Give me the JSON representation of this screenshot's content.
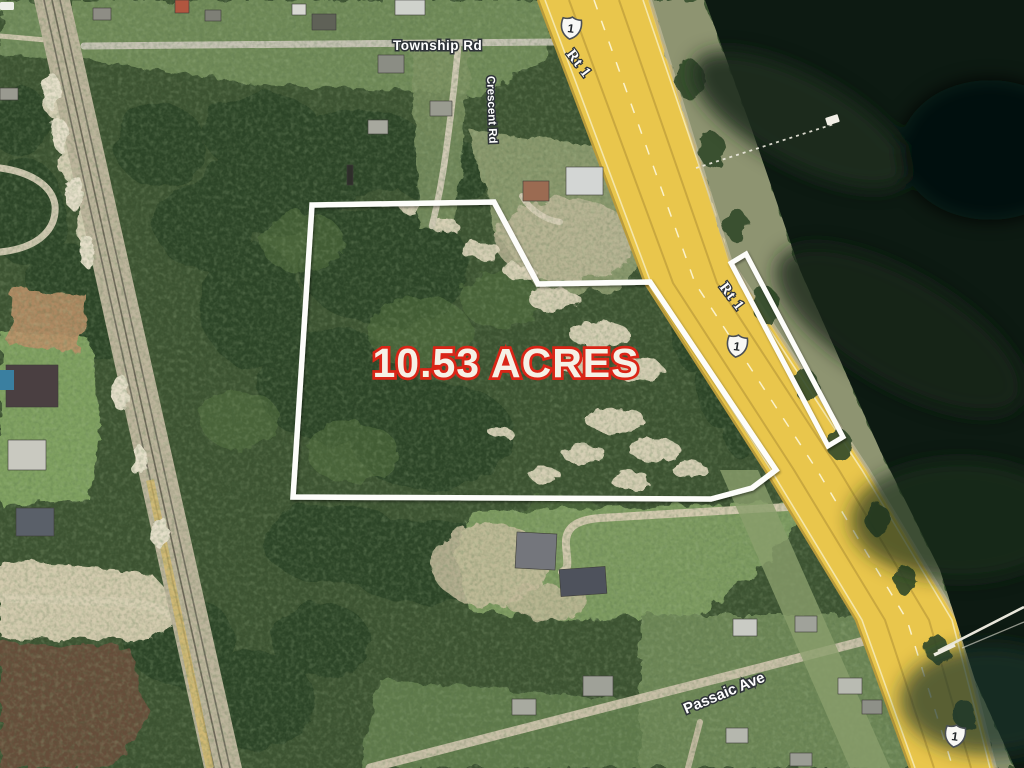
{
  "map": {
    "acreage_label": "10.53 ACRES",
    "roads": {
      "township": "Township Rd",
      "crescent": "Crescent Rd",
      "rt1_upper": "Rt 1",
      "rt1_lower": "Rt 1",
      "passaic": "Passaic Ave"
    },
    "route_shield": {
      "number": "1"
    },
    "colors": {
      "parcel_outline": "#fdfdfa",
      "acreage_fill": "#f5f1e6",
      "acreage_stroke": "#da2517",
      "highway": "#e9c64c",
      "water": "#0d1a12",
      "label_fill": "#ffffff",
      "label_outline": "#2e3338",
      "forest": "#3c5231"
    }
  }
}
